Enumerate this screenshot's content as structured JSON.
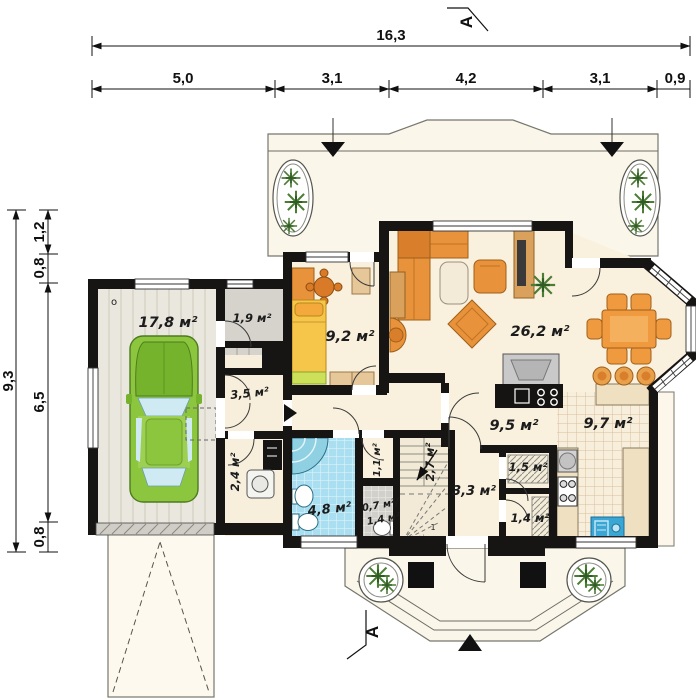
{
  "dimensions": {
    "top_total": "16,3",
    "top_segments": [
      "5,0",
      "3,1",
      "4,2",
      "3,1",
      "0,9"
    ],
    "left_total": "9,3",
    "left_segments": [
      "1,2",
      "0,8",
      "6,5",
      "0,8"
    ]
  },
  "section_marker": "A",
  "rooms": {
    "garage": "17,8 м²",
    "storage_top": "1,9 м²",
    "side_hall": "3,5 м²",
    "boiler_room": "2,4 м²",
    "bedroom": "9,2 м²",
    "living_room": "26,2 м²",
    "hall": "9,5 м²",
    "kitchen": "9,7 м²",
    "corridor": "3,3 м²",
    "pantry": "1,5 м²",
    "storage_bottom": "1,4 м²",
    "bathroom": "4,8 м²",
    "wc_upper": "0,7 м²/",
    "wc_lower": "1,4 м²",
    "stairs": "2,7 м²",
    "stair_niche": "1,1 м²"
  },
  "marks": {
    "garage_corner": "o",
    "stair_first_step": "1"
  },
  "colors": {
    "wall": "#171514",
    "floor_cream": "#f9f1de",
    "terrace": "#fbf6ea",
    "garage_floor": "#eae7df",
    "gray_room": "#d6d3cc",
    "bath_tile": "#a9dff0",
    "kitchen_grid": "#d9bf9b",
    "furniture_orange": "#e8923c",
    "car_green": "#8cc63e",
    "plant_green": "#4c7d35",
    "counter_beige": "#f0e0c2",
    "sink_blue": "#3aa6d4"
  }
}
